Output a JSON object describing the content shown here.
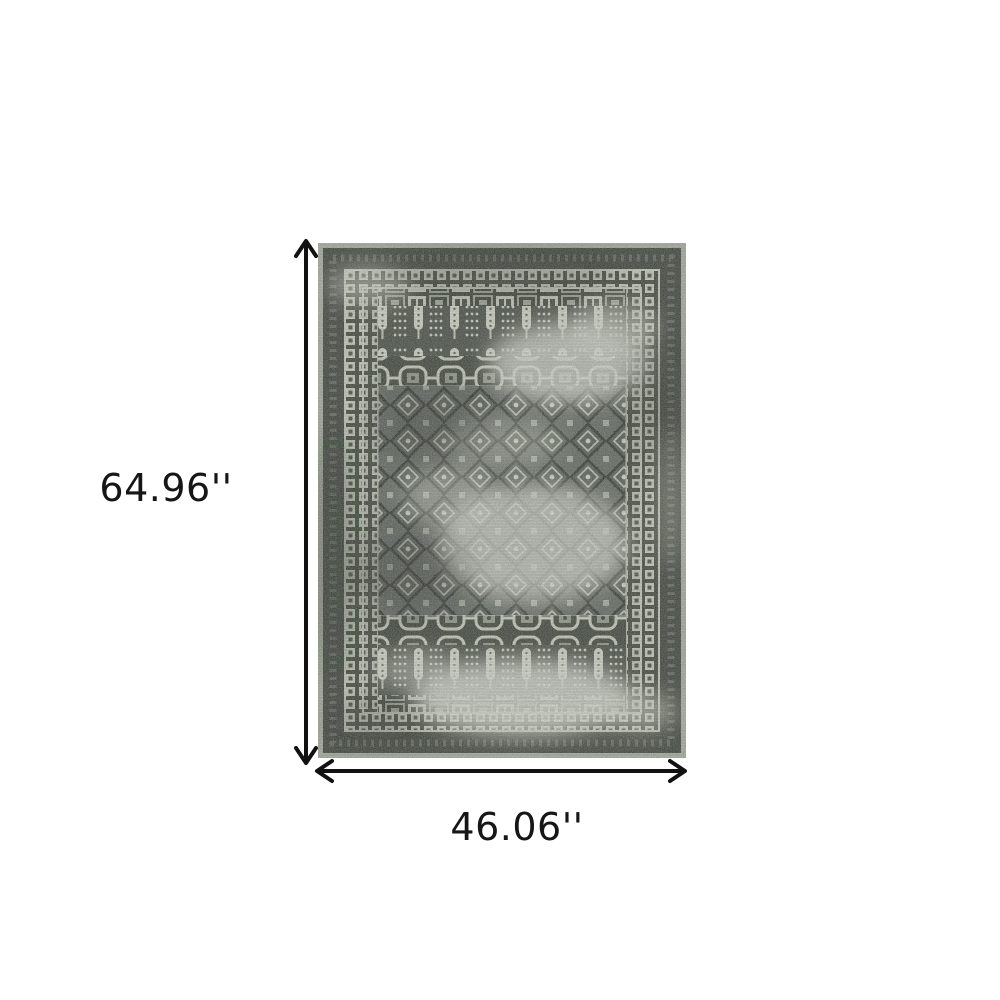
{
  "page": {
    "background": "#ffffff",
    "description": "Product dimension diagram of a distressed traditional oriental area rug on a white background"
  },
  "dimensions": {
    "height_label": "64.96''",
    "width_label": "46.06''"
  },
  "rug": {
    "alt": "Gray charcoal and ivory distressed vintage oriental area rug with bordered frame, candle/cypress motif bands and diamond lattice field",
    "palette": {
      "edge_mottle": "#a6aba0",
      "charcoal_border": "#2f342e",
      "guard_square": "#c9cdbf",
      "field_base": "#454c45",
      "lattice_ground": "#59605a",
      "diamond_outline": "#242922",
      "ivory_line": "#c7cbbd",
      "faded_wear": "#d8dad2"
    }
  },
  "annotations": {
    "arrow_color": "#111111",
    "label_color": "#161616"
  }
}
